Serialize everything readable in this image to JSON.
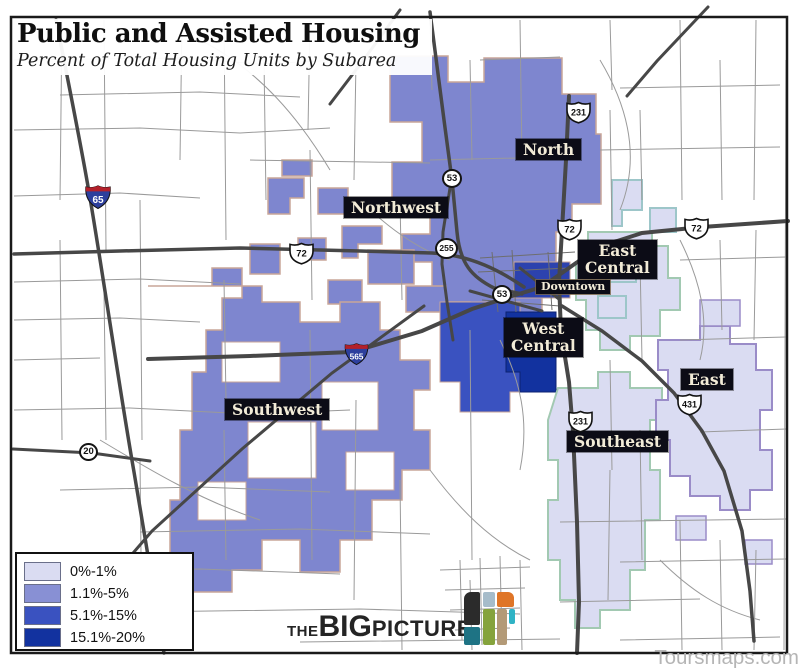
{
  "title": {
    "heading": "Public and Assisted Housing",
    "subheading": "Percent of Total Housing Units by Subarea"
  },
  "legend": {
    "items": [
      {
        "label": "0%-1%",
        "color": "#dadcf2"
      },
      {
        "label": "1.1%-5%",
        "color": "#8890d4"
      },
      {
        "label": "5.1%-15%",
        "color": "#3a52c0"
      },
      {
        "label": "15.1%-20%",
        "color": "#12329f"
      }
    ]
  },
  "map": {
    "labels": {
      "north": "North",
      "northwest": "Northwest",
      "east_central_1": "East",
      "east_central_2": "Central",
      "downtown": "Downtown",
      "west_central_1": "West",
      "west_central_2": "Central",
      "southwest": "Southwest",
      "southeast": "Southeast",
      "east": "East"
    },
    "shields": {
      "i65": "65",
      "i565": "565",
      "us231": "231",
      "us72": "72",
      "us431": "431",
      "c53": "53",
      "c255": "255",
      "c20": "20"
    },
    "colors": {
      "pct_0_1": "#dadcf2",
      "pct_1_5": "#8890d4",
      "pct_5_15": "#3a52c0",
      "pct_15_20": "#12329f",
      "subarea_fill_medium": "#7e86cf",
      "border_tan": "#c9a598",
      "border_green": "#a2c9b2",
      "border_purple": "#9a8cc8",
      "border_teal": "#9dc6c9",
      "road_major": "#474747",
      "label_bg": "#0c0c16",
      "label_text": "#f2ebd7"
    }
  },
  "logo": {
    "part1": "THE",
    "part2": "BIG",
    "part3": "PICTURE",
    "tile_colors": [
      "#2b2b2b",
      "#1e7384",
      "#a6bcca",
      "#85a33c",
      "#df7527",
      "#b39a77",
      "#2fb3c5"
    ]
  },
  "watermark": "Toursmaps.com"
}
